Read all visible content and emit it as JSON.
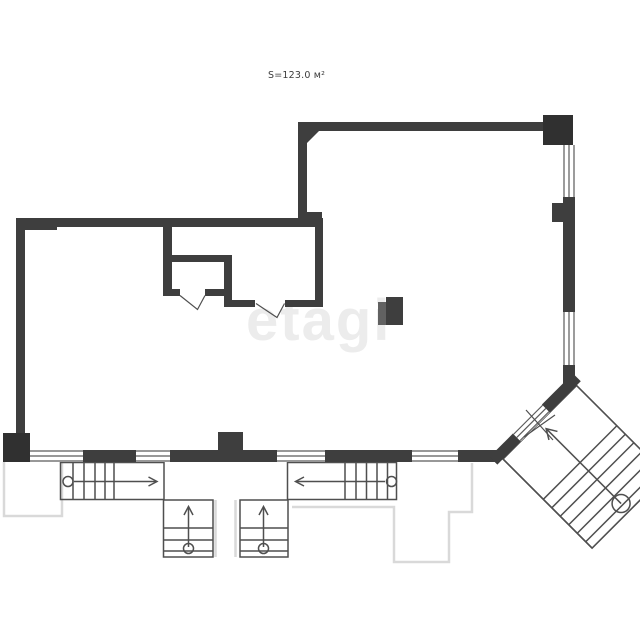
{
  "plan": {
    "area_label": "S=123.0 м²",
    "watermark": "etagi"
  },
  "icons": {
    "stair_direction_arrows": [
      "right",
      "left",
      "up",
      "up",
      "diagonal-up-left"
    ]
  },
  "colors": {
    "background": "#ffffff",
    "wall": "#3e3e3e",
    "wall_dark": "#303030",
    "column_light": "#616161",
    "line": "#4f4f4f",
    "window_line": "#5a5a5a",
    "door_line": "#4f4f4f",
    "terrace_line": "#d9d9d9",
    "watermark": "#ececec",
    "label": "#3c3c3c"
  }
}
